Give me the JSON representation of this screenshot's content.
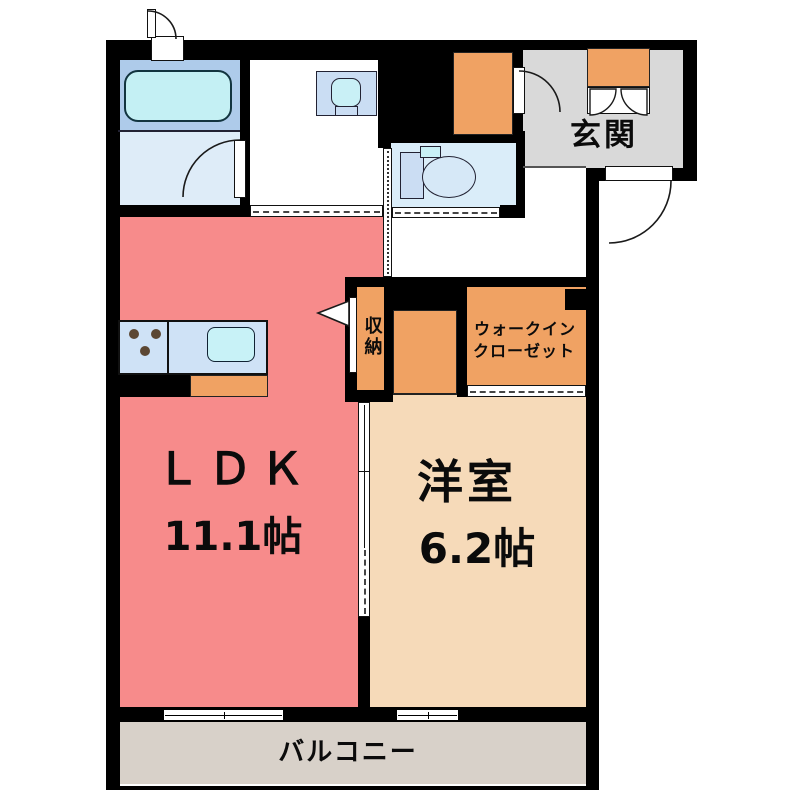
{
  "plan": {
    "rooms": {
      "ldk": {
        "label": "ＬＤＫ",
        "size": "11.1帖"
      },
      "western": {
        "label": "洋室",
        "size": "6.2帖"
      },
      "entrance": {
        "label": "玄関"
      },
      "storage": {
        "label": "収納"
      },
      "wic": {
        "line1": "ウォークイン",
        "line2": "クローゼット"
      },
      "balcony": {
        "label": "バルコニー"
      }
    },
    "fixtures": {
      "bathtub": "bathtub",
      "vanity": "vanity-sink",
      "toilet": "toilet",
      "stove": "gas-stove-3-burners",
      "kitchen_sink": "kitchen-sink",
      "shoe_cabinet": "shoe-cabinet"
    },
    "colors": {
      "wall": "#000000",
      "ldk": "#F78B8B",
      "western": "#F6DAB9",
      "closet_orange": "#F0A263",
      "entrance_gray": "#D9D9D9",
      "balcony_gray": "#D8D1C9",
      "bath_blue": "#AECBEA",
      "bath_floor": "#DEECF8",
      "toilet_blue": "#DAEDF9",
      "tub_cyan": "#C4F0F4",
      "counter_blue": "#CFE2F6"
    }
  }
}
